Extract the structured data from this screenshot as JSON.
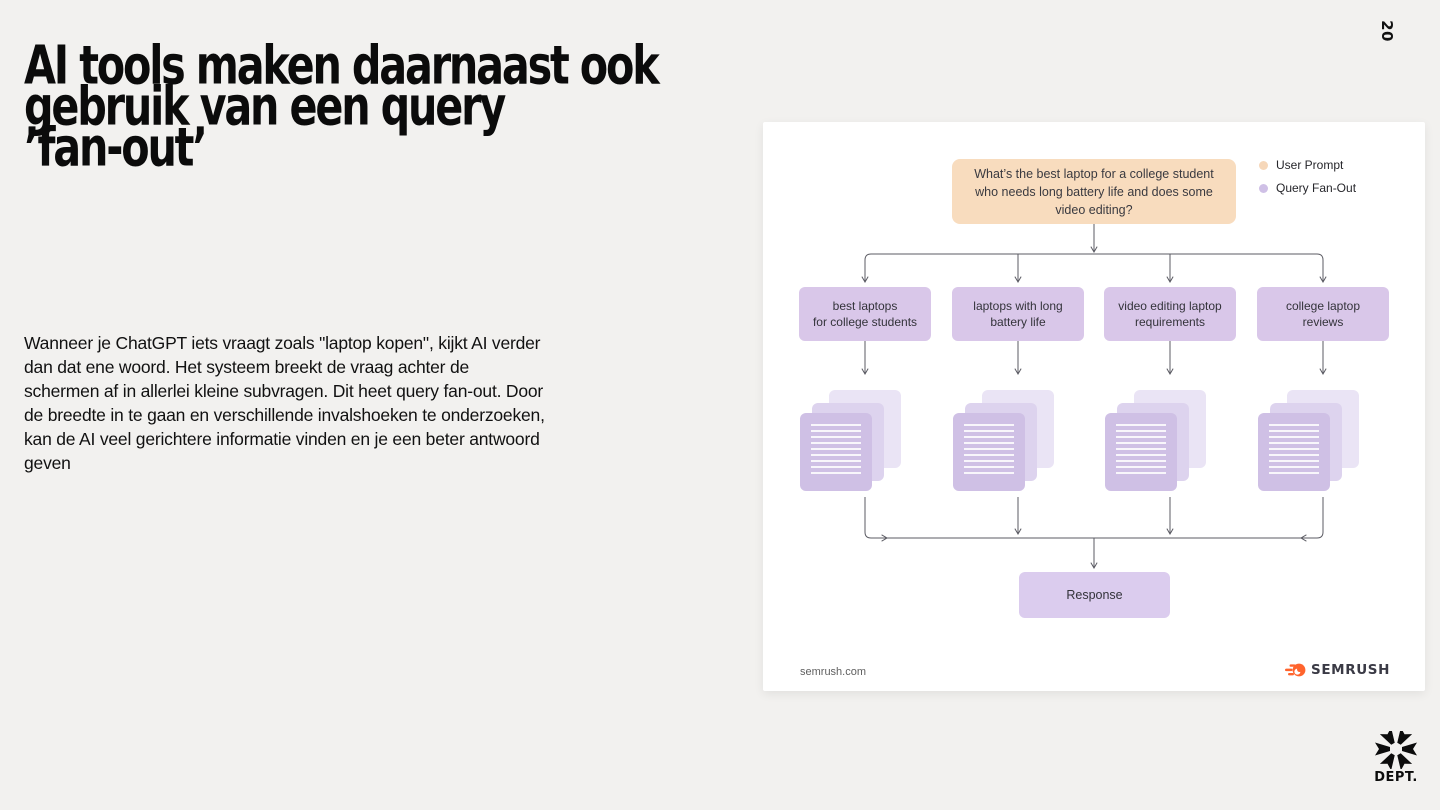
{
  "page": {
    "number": "20"
  },
  "title": "AI tools maken daarnaast ook\ngebruik van een query\n’fan-out’",
  "body": "Wanneer je ChatGPT iets vraagt zoals \"laptop kopen\", kijkt  AI verder\ndan dat ene woord. Het systeem breekt de vraag achter de\nschermen af in allerlei kleine subvragen. Dit heet query fan-out. Door\nde breedte in te gaan en verschillende invalshoeken te onderzoeken,\nkan de AI veel gerichtere informatie vinden en je een beter antwoord\ngeven",
  "diagram": {
    "prompt": "What’s the best laptop for a college student\nwho needs long battery life and does some\nvideo editing?",
    "legend": [
      {
        "label": "User Prompt",
        "color": "#F6D7B9"
      },
      {
        "label": "Query Fan-Out",
        "color": "#CFC0E6"
      }
    ],
    "queries": [
      "best laptops\nfor college students",
      "laptops with long\nbattery life",
      "video editing laptop\nrequirements",
      "college laptop\nreviews"
    ],
    "response_label": "Response",
    "source": "semrush.com",
    "brand": "SEMRUSH"
  },
  "footer": {
    "brand": "DEPT."
  },
  "colors": {
    "slide_background": "#F2F1EF",
    "card_background": "#FFFFFF",
    "user_prompt_fill": "#F8DCBE",
    "query_fill": "#D9C7E9",
    "response_fill": "#DBCCEE",
    "doc_front": "#CFC0E5",
    "doc_mid": "#DDD3EE",
    "doc_back": "#EAE4F5",
    "arrow_stroke": "#5B5B63",
    "semrush_orange": "#FF642D",
    "text_dark": "#111111"
  }
}
